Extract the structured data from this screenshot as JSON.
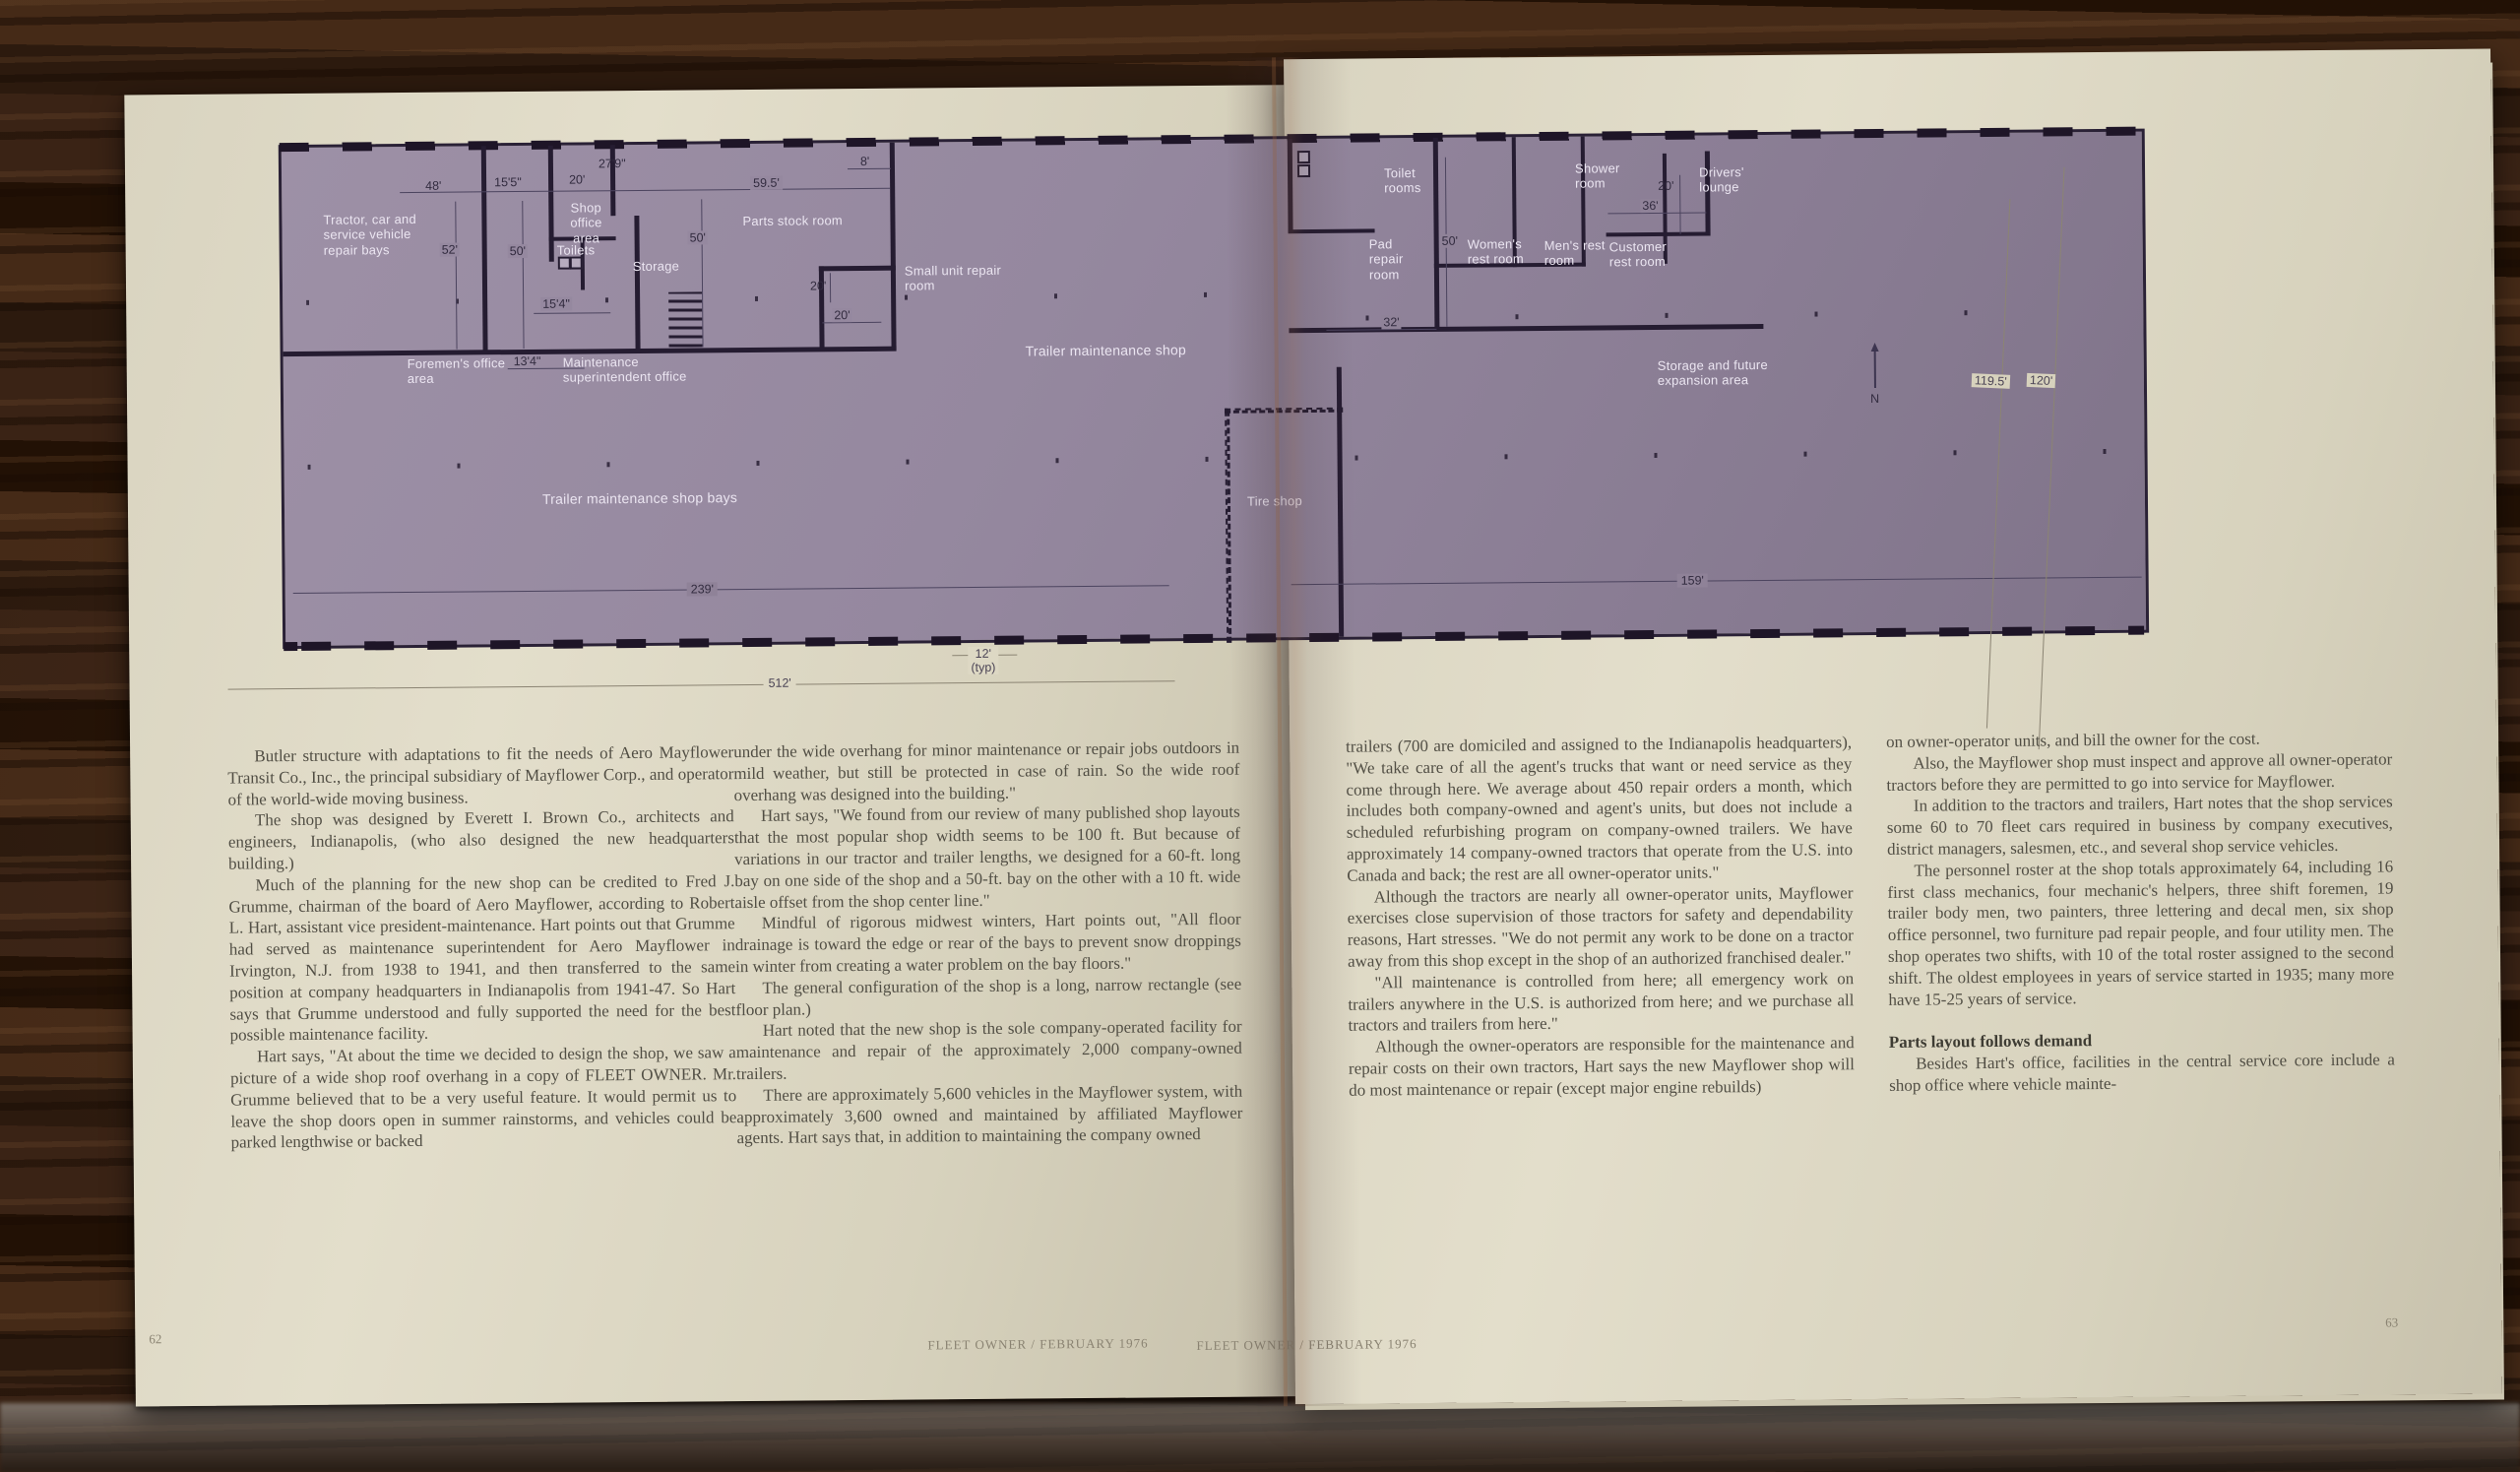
{
  "publication": {
    "footer_left": "FLEET OWNER / FEBRUARY 1976",
    "footer_right": "FLEET OWNER / FEBRUARY 1976",
    "page_number_left": "62",
    "page_number_right": "63"
  },
  "floor_plan": {
    "rooms": {
      "tractor_bays": "Tractor, car and service vehicle repair bays",
      "shop_office": "Shop office area",
      "toilets": "Toilets",
      "storage": "Storage",
      "parts_stock": "Parts stock room",
      "small_unit": "Small unit repair room",
      "foremens_office": "Foremen's office area",
      "maintenance_super": "Maintenance superintendent office",
      "trailer_shop": "Trailer maintenance shop",
      "trailer_bays": "Trailer maintenance shop bays",
      "tire_shop": "Tire shop",
      "toilet_rooms": "Toilet rooms",
      "pad_repair": "Pad repair room",
      "womens_rest": "Women's rest room",
      "mens_rest": "Men's rest room",
      "customer_rest": "Customer rest room",
      "shower": "Shower room",
      "drivers_lounge": "Drivers' lounge",
      "storage_future": "Storage and future expansion area"
    },
    "dims": {
      "d48": "48'",
      "d15_5": "15'5\"",
      "d20a": "20'",
      "d27_9": "27'9\"",
      "d59_5": "59.5'",
      "d8": "8'",
      "d52": "52'",
      "d50a": "50'",
      "d50b": "50'",
      "d50c": "50'",
      "d20b": "20'",
      "d20c": "20'",
      "d15_4": "15'4\"",
      "d13_4": "13'4\"",
      "d239": "239'",
      "d512": "512'",
      "d12typ": "12'\n(typ)",
      "d32": "32'",
      "d36": "36'",
      "d20d": "20'",
      "d119_5": "119.5'",
      "d120": "120'",
      "d159": "159'",
      "north": "N"
    },
    "colors": {
      "plan_fill": "#93869d",
      "wall": "#251c31",
      "label_text": "#ebe5f1",
      "paper": "#d9d4c0"
    }
  },
  "article": {
    "subhead": "Parts layout follows demand",
    "columns": [
      {
        "paragraphs": [
          "Butler structure with adaptations to fit the needs of Aero Mayflower Transit Co., Inc., the principal subsidiary of Mayflower Corp., and operator of the world-wide moving business.",
          "The shop was designed by Everett I. Brown Co., architects and engineers, Indianapolis, (who also designed the new headquarters building.)",
          "Much of the planning for the new shop can be credited to Fred J. Grumme, chairman of the board of Aero Mayflower, according to Robert L. Hart, assistant vice president-maintenance. Hart points out that Grumme had served as maintenance superintendent for Aero Mayflower in Irvington, N.J. from 1938 to 1941, and then transferred to the same position at company headquarters in Indianapolis from 1941-47. So Hart says that Grumme understood and fully supported the need for the best possible maintenance facility.",
          "Hart says, \"At about the time we decided to design the shop, we saw a picture of a wide shop roof overhang in a copy of FLEET OWNER. Mr. Grumme believed that to be a very useful feature. It would permit us to leave the shop doors open in summer rainstorms, and vehicles could be parked lengthwise or backed"
        ]
      },
      {
        "paragraphs": [
          "under the wide overhang for minor maintenance or repair jobs outdoors in mild weather, but still be protected in case of rain. So the wide roof overhang was designed into the building.\"",
          "Hart says, \"We found from our review of many published shop layouts that the most popular shop width seems to be 100 ft. But because of variations in our tractor and trailer lengths, we designed for a 60-ft. long bay on one side of the shop and a 50-ft. bay on the other with a 10 ft. wide aisle offset from the shop center line.\"",
          "Mindful of rigorous midwest winters, Hart points out, \"All floor drainage is toward the edge or rear of the bays to prevent snow droppings in winter from creating a water problem on the bay floors.\"",
          "The general configuration of the shop is a long, narrow rectangle (see floor plan.)",
          "Hart noted that the new shop is the sole company-operated facility for maintenance and repair of the approximately 2,000 company-owned trailers.",
          "There are approximately 5,600 vehicles in the Mayflower system, with approximately 3,600 owned and maintained by affiliated Mayflower agents. Hart says that, in addition to maintaining the company owned"
        ]
      },
      {
        "paragraphs": [
          "trailers (700 are domiciled and assigned to the Indianapolis headquarters), \"We take care of all the agent's trucks that want or need service as they come through here. We average about 450 repair orders a month, which includes both company-owned and agent's units, but does not include a scheduled refurbishing program on company-owned trailers. We have approximately 14 company-owned tractors that operate from the U.S. into Canada and back; the rest are all owner-operator units.\"",
          "Although the tractors are nearly all owner-operator units, Mayflower exercises close supervision of those tractors for safety and dependability reasons, Hart stresses. \"We do not permit any work to be done on a tractor away from this shop except in the shop of an authorized franchised dealer.\"",
          "\"All maintenance is controlled from here; all emergency work on trailers anywhere in the U.S. is authorized from here; and we purchase all tractors and trailers from here.\"",
          "Although the owner-operators are responsible for the maintenance and repair costs on their own tractors, Hart says the new Mayflower shop will do most maintenance or repair (except major engine rebuilds)"
        ]
      },
      {
        "paragraphs": [
          "on owner-operator units, and bill the owner for the cost.",
          "Also, the Mayflower shop must inspect and approve all owner-operator tractors before they are permitted to go into service for Mayflower.",
          "In addition to the tractors and trailers, Hart notes that the shop services some 60 to 70 fleet cars required in business by company executives, district managers, salesmen, etc., and several shop service vehicles.",
          "The personnel roster at the shop totals approximately 64, including 16 first class mechanics, four mechanic's helpers, three shift foremen, 19 trailer body men, two painters, three lettering and decal men, six shop office personnel, two furniture pad repair people, and four utility men. The shop operates two shifts, with 10 of the total roster assigned to the second shift. The oldest employees in years of service started in 1935; many more have 15-25 years of service.",
          "Besides Hart's office, facilities in the central service core include a shop office where vehicle mainte-"
        ]
      }
    ]
  }
}
